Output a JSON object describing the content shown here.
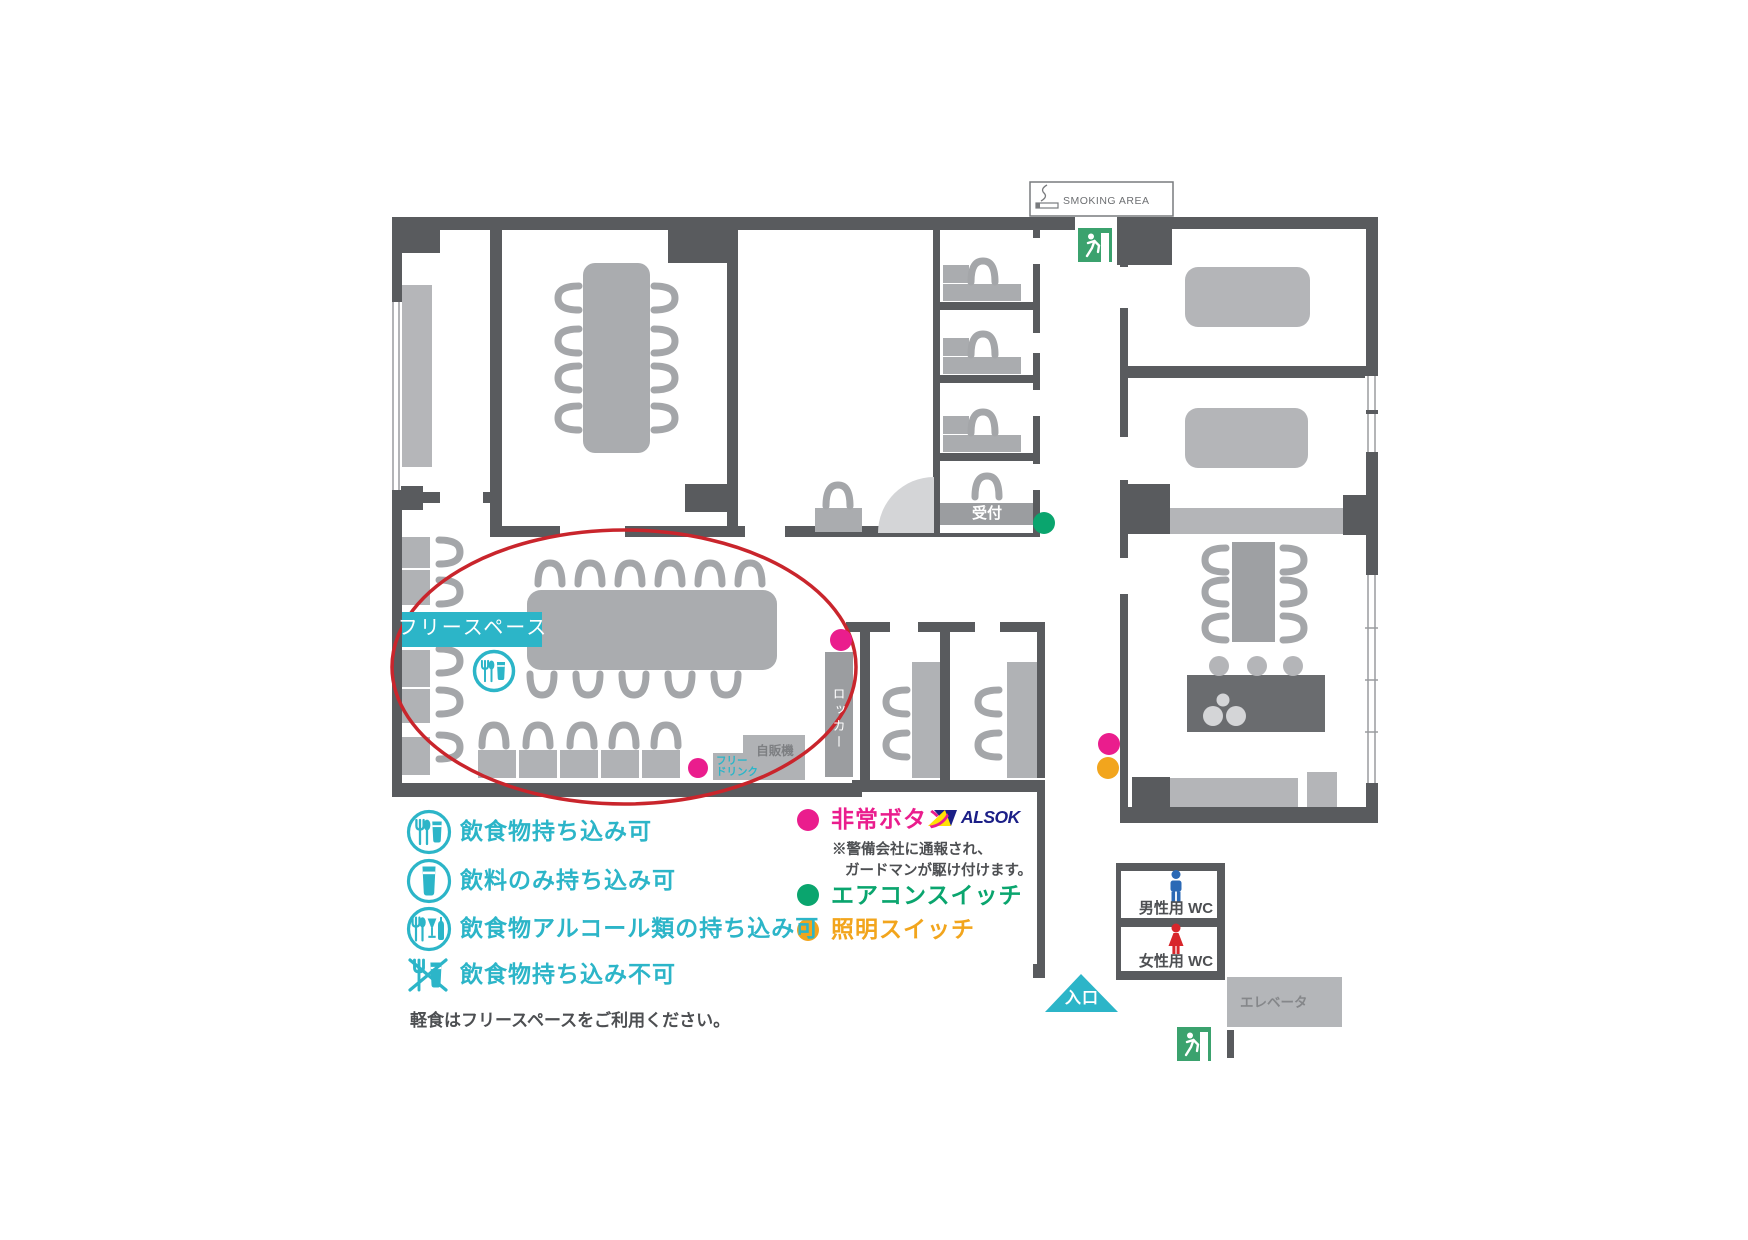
{
  "map": {
    "smoking_area": "SMOKING AREA",
    "reception": "受付",
    "free_space": "フリースペース",
    "locker": "ロッカー",
    "vending_machine": "自販機",
    "free_drink_line1": "フリー",
    "free_drink_line2": "ドリンク",
    "mens_wc": "男性用 WC",
    "womens_wc": "女性用 WC",
    "elevator": "エレベータ",
    "entrance": "入口"
  },
  "legend_food": {
    "items": [
      {
        "icon": "food-and-drink-allowed-icon",
        "label": "飲食物持ち込み可"
      },
      {
        "icon": "drink-only-allowed-icon",
        "label": "飲料のみ持ち込み可"
      },
      {
        "icon": "food-and-alcohol-allowed-icon",
        "label": "飲食物アルコール類の持ち込み可"
      },
      {
        "icon": "food-and-drink-prohibited-icon",
        "label": "飲食物持ち込み不可"
      }
    ],
    "note": "軽食はフリースペースをご利用ください。"
  },
  "legend_markers": {
    "emergency_label": "非常ボタン",
    "alsok": "ALSOK",
    "emergency_note_line1": "※警備会社に通報され、",
    "emergency_note_line2": "ガードマンが駆け付けます。",
    "aircon_label": "エアコンスイッチ",
    "light_label": "照明スイッチ"
  },
  "colors": {
    "wall": "#595b5e",
    "furniture": "#aaacaf",
    "accent_cyan": "#2cb5c8",
    "marker_magenta": "#ea1d8d",
    "marker_green": "#0aa56e",
    "marker_orange": "#f2a51d",
    "highlight_red": "#c9252c",
    "alsok_navy": "#1b1f87",
    "alsok_yellow": "#ffe104",
    "exit_green": "#3ba26e",
    "wc_blue": "#2b69b5",
    "wc_red": "#d8262b"
  }
}
